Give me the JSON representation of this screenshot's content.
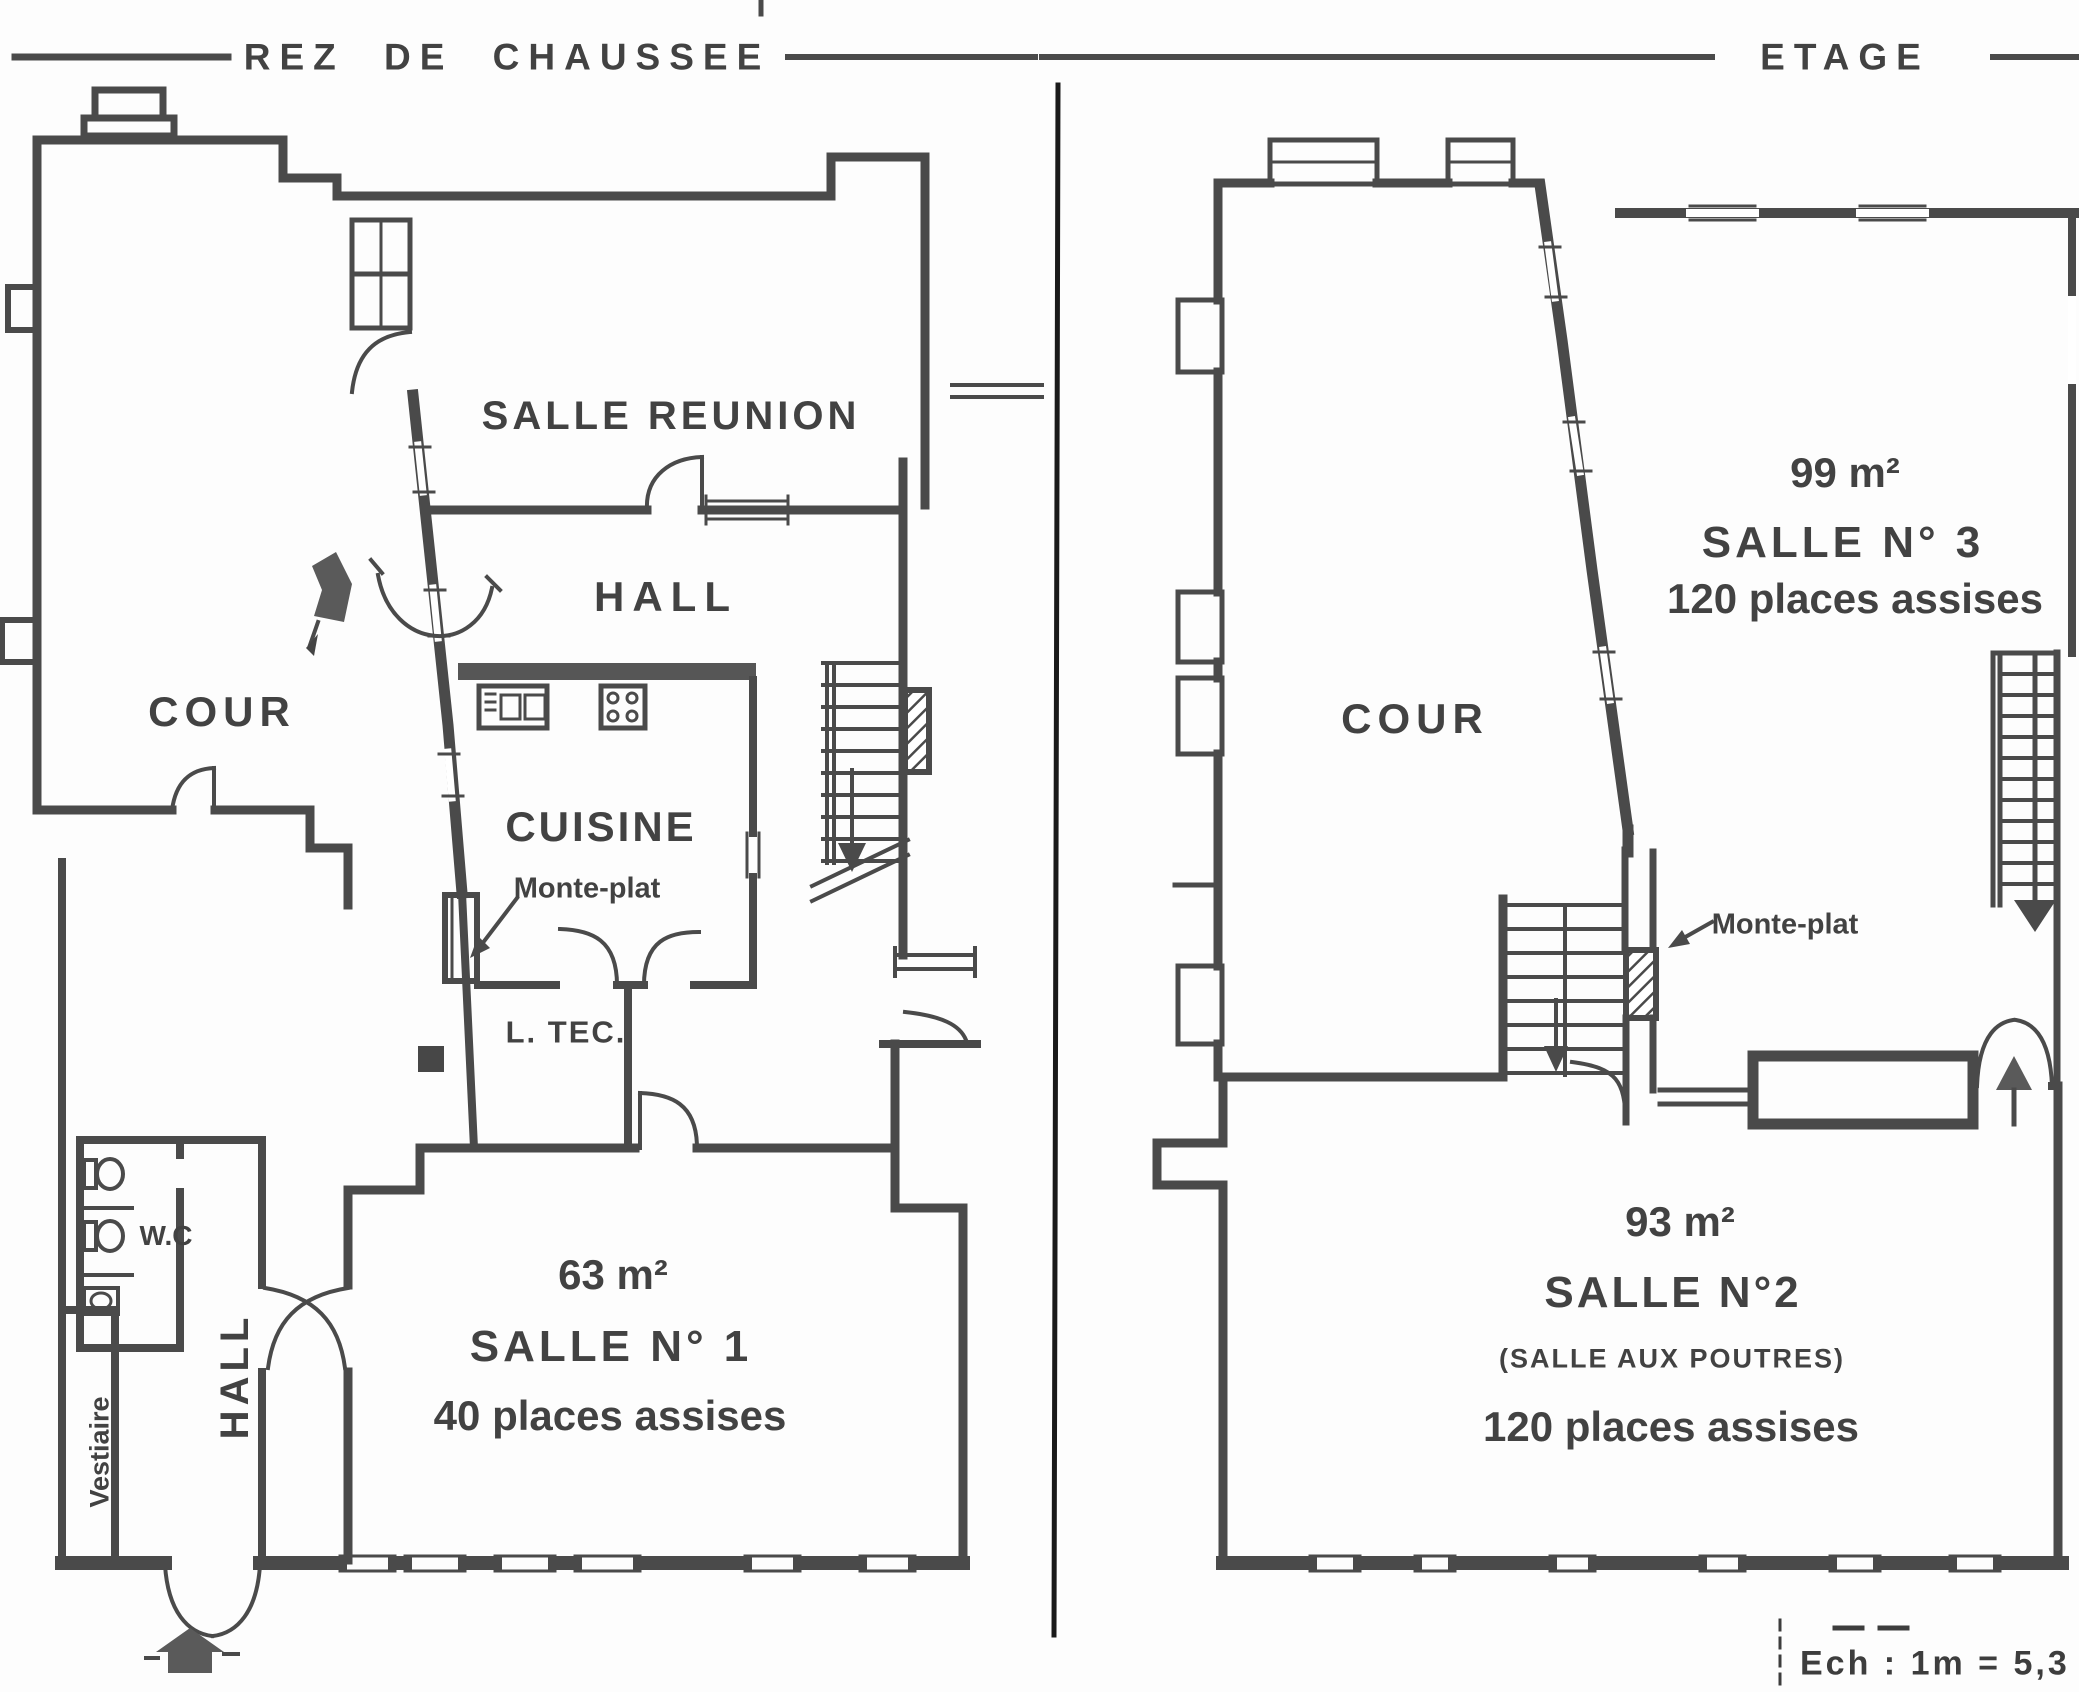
{
  "document": {
    "type": "architectural floor plan (scanned)",
    "scale_note": "Ech : 1m = 5,3 m"
  },
  "header": {
    "left_title": "REZ DE CHAUSSEE",
    "right_title": "ETAGE"
  },
  "ground_floor": {
    "labels": {
      "salle_reunion": "SALLE REUNION",
      "hall_upper": "HALL",
      "cour": "COUR",
      "cuisine": "CUISINE",
      "monte_plat": "Monte-plat",
      "local_technique": "L. TEC.",
      "wc": "W.C",
      "hall_lower": "HALL",
      "vestiaire": "Vestiaire",
      "salle1_area": "63 m²",
      "salle1_name": "SALLE N° 1",
      "salle1_capacity": "40 places assises"
    }
  },
  "upper_floor": {
    "labels": {
      "salle3_area": "99 m²",
      "salle3_name": "SALLE N° 3",
      "salle3_capacity": "120 places assises",
      "cour": "COUR",
      "monte_plat": "Monte-plat",
      "salle2_area": "93 m²",
      "salle2_name": "SALLE N°2",
      "salle2_subtitle": "(SALLE AUX POUTRES)",
      "salle2_capacity": "120 places assises"
    }
  },
  "scale": {
    "text": "Ech : 1m = 5,3 m"
  },
  "colors": {
    "ink": "#4a4a4a",
    "divider": "#1a1a1a",
    "background": "#fdfdfd",
    "fill_dark": "#565656"
  }
}
